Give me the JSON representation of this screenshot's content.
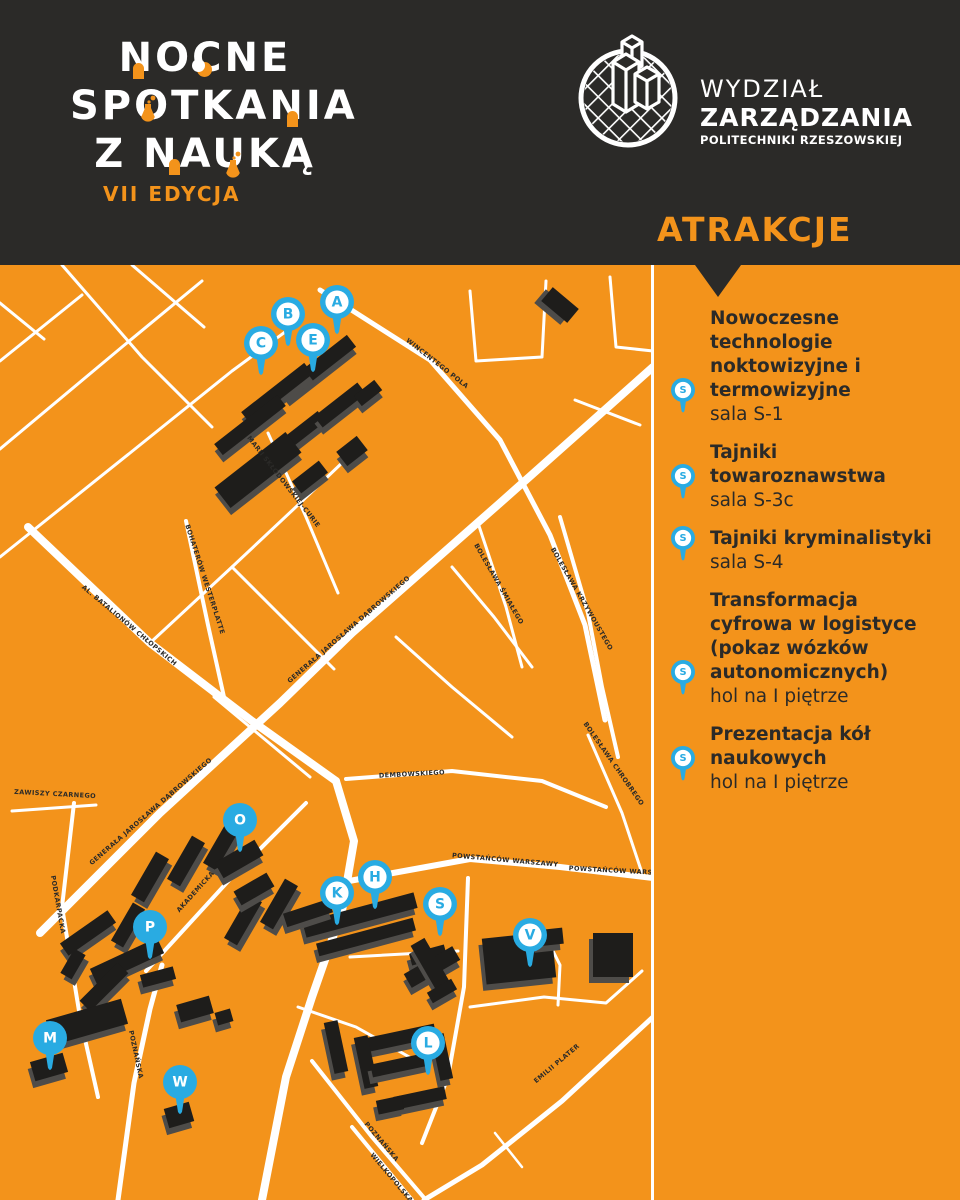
{
  "colors": {
    "orange": "#F3931B",
    "dark": "#2B2A28",
    "blue": "#29ABE2",
    "white": "#FFFFFF",
    "building": "#1E1D1B",
    "building_shadow": "#4E4C49",
    "street_label": "#2B2A28"
  },
  "header": {
    "title_lines": [
      "NOCNE",
      "SPOTKANIA",
      "Z NAUKĄ"
    ],
    "edition": "VII EDYCJA",
    "logo": {
      "line1": "WYDZIAŁ",
      "line2": "ZARZĄDZANIA",
      "line3": "POLITECHNIKI RZESZOWSKIEJ"
    },
    "attractions_heading": "ATRAKCJE"
  },
  "sidebar": {
    "items": [
      {
        "pin_letter": "S",
        "title": "Nowoczesne technologie noktowizyjne i termowizyjne",
        "location": "sala S-1"
      },
      {
        "pin_letter": "S",
        "title": "Tajniki towaroznawstwa",
        "location": "sala S-3c"
      },
      {
        "pin_letter": "S",
        "title": "Tajniki kryminalistyki",
        "location": "sala S-4"
      },
      {
        "pin_letter": "S",
        "title": "Transformacja cyfrowa w logistyce (pokaz wózków autonomicznych)",
        "location": "hol na I piętrze"
      },
      {
        "pin_letter": "S",
        "title": "Prezentacja kół naukowych",
        "location": "hol na I piętrze"
      }
    ]
  },
  "map": {
    "pins": [
      {
        "letter": "A",
        "x": 337,
        "y": 37,
        "style": "outline"
      },
      {
        "letter": "B",
        "x": 288,
        "y": 49,
        "style": "outline"
      },
      {
        "letter": "C",
        "x": 261,
        "y": 78,
        "style": "outline"
      },
      {
        "letter": "E",
        "x": 313,
        "y": 75,
        "style": "outline"
      },
      {
        "letter": "O",
        "x": 240,
        "y": 555,
        "style": "solid"
      },
      {
        "letter": "P",
        "x": 150,
        "y": 662,
        "style": "solid"
      },
      {
        "letter": "K",
        "x": 337,
        "y": 628,
        "style": "outline"
      },
      {
        "letter": "H",
        "x": 375,
        "y": 612,
        "style": "outline"
      },
      {
        "letter": "S",
        "x": 440,
        "y": 639,
        "style": "outline"
      },
      {
        "letter": "V",
        "x": 530,
        "y": 670,
        "style": "outline"
      },
      {
        "letter": "M",
        "x": 50,
        "y": 773,
        "style": "solid"
      },
      {
        "letter": "W",
        "x": 180,
        "y": 817,
        "style": "solid"
      },
      {
        "letter": "L",
        "x": 428,
        "y": 778,
        "style": "outline"
      }
    ],
    "street_labels": [
      {
        "name": "WINCENTEGO POLA",
        "x": 436,
        "y": 100,
        "rot": 38
      },
      {
        "name": "GENERAŁA JAROSŁAWA DĄBROWSKIEGO",
        "x": 350,
        "y": 366,
        "rot": -41
      },
      {
        "name": "GENERAŁA JAROSŁAWA DĄBROWSKIEGO",
        "x": 152,
        "y": 548,
        "rot": -41
      },
      {
        "name": "AL. BATALIONÓW CHŁOPSKICH",
        "x": 128,
        "y": 362,
        "rot": 40
      },
      {
        "name": "BOHATERÓW WESTERPLATTE",
        "x": 203,
        "y": 315,
        "rot": 72
      },
      {
        "name": "MARII SKŁODOWSKIEJ-CURIE",
        "x": 282,
        "y": 218,
        "rot": 52
      },
      {
        "name": "ZAWISZY CZARNEGO",
        "x": 55,
        "y": 531,
        "rot": 3
      },
      {
        "name": "DEMBOWSKIEGO",
        "x": 412,
        "y": 511,
        "rot": -3
      },
      {
        "name": "POWSTAŃCÓW WARSZAWY",
        "x": 505,
        "y": 597,
        "rot": 5
      },
      {
        "name": "POWSTAŃCÓW WARSZAWY",
        "x": 622,
        "y": 608,
        "rot": 3
      },
      {
        "name": "AKADEMICKA",
        "x": 197,
        "y": 628,
        "rot": -48
      },
      {
        "name": "PODKARPACKA",
        "x": 56,
        "y": 640,
        "rot": 80
      },
      {
        "name": "POZNAŃSKA",
        "x": 134,
        "y": 790,
        "rot": 78
      },
      {
        "name": "POZNAŃSKA",
        "x": 380,
        "y": 878,
        "rot": 50
      },
      {
        "name": "WIELKOPOLSKA",
        "x": 390,
        "y": 914,
        "rot": 50
      },
      {
        "name": "EMILII PLATER",
        "x": 558,
        "y": 800,
        "rot": -40
      },
      {
        "name": "BOLESŁAWA ŚMIAŁEGO",
        "x": 497,
        "y": 320,
        "rot": 60
      },
      {
        "name": "BOLESŁAWA KRZYWOUSTEGO",
        "x": 580,
        "y": 335,
        "rot": 60
      },
      {
        "name": "BOLESŁAWA CHROBREGO",
        "x": 612,
        "y": 500,
        "rot": 55
      }
    ],
    "roads": [
      {
        "w": 8,
        "pts": [
          [
            40,
            668
          ],
          [
            160,
            548
          ],
          [
            280,
            438
          ],
          [
            352,
            368
          ],
          [
            500,
            238
          ],
          [
            653,
            102
          ]
        ]
      },
      {
        "w": 8,
        "pts": [
          [
            28,
            262
          ],
          [
            150,
            378
          ],
          [
            252,
            456
          ],
          [
            336,
            516
          ]
        ]
      },
      {
        "w": 8,
        "pts": [
          [
            336,
            516
          ],
          [
            354,
            576
          ],
          [
            342,
            646
          ],
          [
            312,
            732
          ],
          [
            286,
            812
          ],
          [
            262,
            935
          ]
        ]
      },
      {
        "w": 6,
        "pts": [
          [
            349,
            616
          ],
          [
            470,
            594
          ],
          [
            560,
            602
          ],
          [
            653,
            613
          ]
        ]
      },
      {
        "w": 5,
        "pts": [
          [
            320,
            25
          ],
          [
            430,
            95
          ],
          [
            500,
            175
          ],
          [
            550,
            270
          ],
          [
            585,
            360
          ],
          [
            605,
            455
          ]
        ]
      },
      {
        "w": 4,
        "pts": [
          [
            186,
            256
          ],
          [
            208,
            360
          ],
          [
            224,
            432
          ]
        ]
      },
      {
        "w": 4,
        "pts": [
          [
            560,
            252
          ],
          [
            588,
            348
          ],
          [
            602,
            422
          ],
          [
            618,
            492
          ]
        ]
      },
      {
        "w": 3,
        "pts": [
          [
            478,
            258
          ],
          [
            506,
            342
          ],
          [
            522,
            402
          ]
        ]
      },
      {
        "w": 3,
        "pts": [
          [
            588,
            470
          ],
          [
            622,
            548
          ],
          [
            642,
            608
          ]
        ]
      },
      {
        "w": 4,
        "pts": [
          [
            346,
            514
          ],
          [
            452,
            506
          ],
          [
            542,
            516
          ],
          [
            606,
            542
          ]
        ]
      },
      {
        "w": 4,
        "pts": [
          [
            146,
            706
          ],
          [
            232,
            612
          ],
          [
            306,
            538
          ]
        ]
      },
      {
        "w": 4,
        "pts": [
          [
            74,
            538
          ],
          [
            62,
            642
          ],
          [
            80,
            752
          ],
          [
            98,
            832
          ]
        ]
      },
      {
        "w": 3,
        "pts": [
          [
            12,
            546
          ],
          [
            96,
            540
          ]
        ]
      },
      {
        "w": 5,
        "pts": [
          [
            118,
            935
          ],
          [
            134,
            818
          ],
          [
            150,
            744
          ],
          [
            162,
            700
          ]
        ]
      },
      {
        "w": 4,
        "pts": [
          [
            312,
            796
          ],
          [
            372,
            872
          ],
          [
            426,
            935
          ]
        ]
      },
      {
        "w": 4,
        "pts": [
          [
            352,
            862
          ],
          [
            412,
            935
          ]
        ]
      },
      {
        "w": 5,
        "pts": [
          [
            653,
            752
          ],
          [
            562,
            836
          ],
          [
            482,
            900
          ],
          [
            424,
            935
          ]
        ]
      },
      {
        "w": 4,
        "pts": [
          [
            468,
            613
          ],
          [
            464,
            722
          ],
          [
            448,
            812
          ],
          [
            422,
            878
          ]
        ]
      },
      {
        "w": 3,
        "pts": [
          [
            350,
            692
          ],
          [
            458,
            686
          ]
        ]
      },
      {
        "w": 3,
        "pts": [
          [
            470,
            742
          ],
          [
            544,
            732
          ],
          [
            606,
            738
          ],
          [
            642,
            706
          ]
        ]
      },
      {
        "w": 3,
        "pts": [
          [
            298,
            742
          ],
          [
            356,
            762
          ],
          [
            420,
            798
          ]
        ]
      },
      {
        "w": 3,
        "pts": [
          [
            150,
            378
          ],
          [
            232,
            302
          ],
          [
            298,
            240
          ],
          [
            344,
            196
          ]
        ]
      },
      {
        "w": 3,
        "pts": [
          [
            232,
            302
          ],
          [
            282,
            352
          ],
          [
            334,
            404
          ]
        ]
      },
      {
        "w": 3,
        "pts": [
          [
            0,
            96
          ],
          [
            82,
            30
          ]
        ]
      },
      {
        "w": 3,
        "pts": [
          [
            0,
            184
          ],
          [
            122,
            82
          ],
          [
            202,
            16
          ]
        ]
      },
      {
        "w": 3,
        "pts": [
          [
            0,
            292
          ],
          [
            130,
            188
          ],
          [
            232,
            106
          ],
          [
            300,
            56
          ]
        ]
      },
      {
        "w": 3,
        "pts": [
          [
            62,
            0
          ],
          [
            142,
            92
          ],
          [
            212,
            162
          ]
        ]
      },
      {
        "w": 3,
        "pts": [
          [
            132,
            0
          ],
          [
            204,
            62
          ]
        ]
      },
      {
        "w": 3,
        "pts": [
          [
            0,
            38
          ],
          [
            44,
            74
          ]
        ]
      },
      {
        "w": 3,
        "pts": [
          [
            470,
            26
          ],
          [
            476,
            96
          ],
          [
            542,
            92
          ],
          [
            546,
            16
          ]
        ]
      },
      {
        "w": 3,
        "pts": [
          [
            610,
            12
          ],
          [
            616,
            82
          ],
          [
            653,
            86
          ]
        ]
      },
      {
        "w": 3,
        "pts": [
          [
            396,
            372
          ],
          [
            452,
            422
          ],
          [
            512,
            472
          ]
        ]
      },
      {
        "w": 3,
        "pts": [
          [
            452,
            302
          ],
          [
            494,
            352
          ],
          [
            532,
            402
          ]
        ]
      },
      {
        "w": 3,
        "pts": [
          [
            214,
            432
          ],
          [
            262,
            472
          ],
          [
            310,
            512
          ]
        ]
      },
      {
        "w": 3,
        "pts": [
          [
            268,
            168
          ],
          [
            306,
            252
          ],
          [
            338,
            328
          ]
        ]
      },
      {
        "w": 3,
        "pts": [
          [
            540,
            660
          ],
          [
            560,
            700
          ],
          [
            558,
            740
          ]
        ]
      },
      {
        "w": 2.5,
        "pts": [
          [
            495,
            868
          ],
          [
            522,
            902
          ]
        ]
      },
      {
        "w": 3,
        "pts": [
          [
            575,
            135
          ],
          [
            640,
            160
          ]
        ]
      }
    ],
    "buildings": [
      {
        "x": 318,
        "y": 102,
        "w": 85,
        "h": 15,
        "rot": -38
      },
      {
        "x": 277,
        "y": 128,
        "w": 80,
        "h": 14,
        "rot": -38
      },
      {
        "x": 250,
        "y": 160,
        "w": 80,
        "h": 14,
        "rot": -38
      },
      {
        "x": 300,
        "y": 168,
        "w": 55,
        "h": 13,
        "rot": -38
      },
      {
        "x": 340,
        "y": 140,
        "w": 55,
        "h": 14,
        "rot": -38
      },
      {
        "x": 368,
        "y": 128,
        "w": 26,
        "h": 13,
        "rot": -38
      },
      {
        "x": 258,
        "y": 205,
        "w": 90,
        "h": 26,
        "rot": -38
      },
      {
        "x": 310,
        "y": 212,
        "w": 34,
        "h": 15,
        "rot": -38
      },
      {
        "x": 352,
        "y": 186,
        "w": 26,
        "h": 18,
        "rot": -38
      },
      {
        "x": 560,
        "y": 40,
        "w": 34,
        "h": 18,
        "rot": 40
      },
      {
        "x": 150,
        "y": 612,
        "w": 50,
        "h": 15,
        "rot": -60
      },
      {
        "x": 186,
        "y": 596,
        "w": 50,
        "h": 15,
        "rot": -60
      },
      {
        "x": 222,
        "y": 580,
        "w": 50,
        "h": 15,
        "rot": -60
      },
      {
        "x": 243,
        "y": 655,
        "w": 50,
        "h": 15,
        "rot": -60
      },
      {
        "x": 279,
        "y": 639,
        "w": 50,
        "h": 15,
        "rot": -60
      },
      {
        "x": 128,
        "y": 660,
        "w": 44,
        "h": 14,
        "rot": -60
      },
      {
        "x": 239,
        "y": 594,
        "w": 46,
        "h": 18,
        "rot": -30
      },
      {
        "x": 254,
        "y": 624,
        "w": 38,
        "h": 16,
        "rot": -30
      },
      {
        "x": 360,
        "y": 650,
        "w": 115,
        "h": 16,
        "rot": -15
      },
      {
        "x": 366,
        "y": 672,
        "w": 100,
        "h": 13,
        "rot": -15
      },
      {
        "x": 308,
        "y": 648,
        "w": 48,
        "h": 14,
        "rot": -18
      },
      {
        "x": 428,
        "y": 690,
        "w": 36,
        "h": 12,
        "rot": -15
      },
      {
        "x": 432,
        "y": 702,
        "w": 56,
        "h": 16,
        "rot": -30
      },
      {
        "x": 432,
        "y": 702,
        "w": 16,
        "h": 58,
        "rot": -30
      },
      {
        "x": 442,
        "y": 726,
        "w": 28,
        "h": 12,
        "rot": -30
      },
      {
        "x": 519,
        "y": 693,
        "w": 70,
        "h": 46,
        "rot": -6
      },
      {
        "x": 550,
        "y": 672,
        "w": 26,
        "h": 16,
        "rot": -6
      },
      {
        "x": 613,
        "y": 690,
        "w": 40,
        "h": 44,
        "rot": 0
      },
      {
        "x": 88,
        "y": 668,
        "w": 58,
        "h": 15,
        "rot": -35
      },
      {
        "x": 127,
        "y": 696,
        "w": 74,
        "h": 17,
        "rot": -25
      },
      {
        "x": 104,
        "y": 722,
        "w": 54,
        "h": 15,
        "rot": -45
      },
      {
        "x": 158,
        "y": 712,
        "w": 34,
        "h": 13,
        "rot": -15
      },
      {
        "x": 73,
        "y": 699,
        "w": 28,
        "h": 13,
        "rot": -60
      },
      {
        "x": 87,
        "y": 757,
        "w": 78,
        "h": 26,
        "rot": -16
      },
      {
        "x": 49,
        "y": 802,
        "w": 34,
        "h": 20,
        "rot": -16
      },
      {
        "x": 179,
        "y": 850,
        "w": 26,
        "h": 20,
        "rot": -16
      },
      {
        "x": 195,
        "y": 744,
        "w": 34,
        "h": 18,
        "rot": -16
      },
      {
        "x": 224,
        "y": 752,
        "w": 16,
        "h": 13,
        "rot": -16
      },
      {
        "x": 400,
        "y": 773,
        "w": 72,
        "h": 14,
        "rot": -12
      },
      {
        "x": 366,
        "y": 797,
        "w": 14,
        "h": 52,
        "rot": -12
      },
      {
        "x": 400,
        "y": 800,
        "w": 58,
        "h": 13,
        "rot": -12
      },
      {
        "x": 442,
        "y": 792,
        "w": 13,
        "h": 46,
        "rot": -12
      },
      {
        "x": 420,
        "y": 833,
        "w": 52,
        "h": 13,
        "rot": -12
      },
      {
        "x": 390,
        "y": 840,
        "w": 26,
        "h": 14,
        "rot": -12
      },
      {
        "x": 336,
        "y": 782,
        "w": 14,
        "h": 52,
        "rot": -12
      }
    ]
  }
}
